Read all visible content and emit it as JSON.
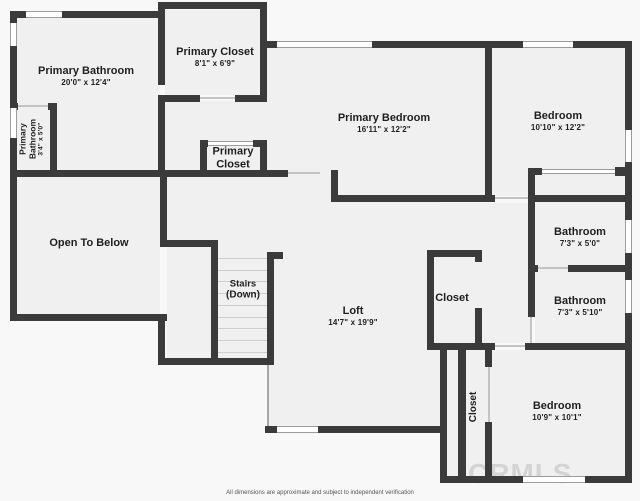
{
  "plan": {
    "watermark": "CRMLS",
    "disclaimer": "All dimensions are approximate and subject to independent verification",
    "colors": {
      "wall": "#3b3b3b",
      "floor": "#f0f0f0",
      "background": "#f8f8f8",
      "label_text": "#1f1f1f"
    },
    "rooms": {
      "primary_bathroom": {
        "name": "Primary Bathroom",
        "dims": "20'0\" x 12'4\""
      },
      "primary_closet": {
        "name": "Primary Closet",
        "dims": "8'1\" x 6'9\""
      },
      "primary_bedroom": {
        "name": "Primary Bedroom",
        "dims": "16'11\" x 12'2\""
      },
      "bedroom_upper": {
        "name": "Bedroom",
        "dims": "10'10\" x 12'2\""
      },
      "primary_bathroom_small": {
        "name": "Primary Bathroom",
        "dims": "3'4\" x 5'0\""
      },
      "primary_closet_small": {
        "name": "Primary Closet"
      },
      "open_to_below": {
        "name": "Open To Below"
      },
      "stairs": {
        "name": "Stairs",
        "sub": "(Down)"
      },
      "loft": {
        "name": "Loft",
        "dims": "14'7\" x 19'9\""
      },
      "closet_hall": {
        "name": "Closet"
      },
      "bathroom_upper": {
        "name": "Bathroom",
        "dims": "7'3\" x 5'0\""
      },
      "bathroom_lower": {
        "name": "Bathroom",
        "dims": "7'3\" x 5'10\""
      },
      "closet_bedroom": {
        "name": "Closet"
      },
      "bedroom_lower": {
        "name": "Bedroom",
        "dims": "10'9\" x 10'1\""
      }
    }
  }
}
